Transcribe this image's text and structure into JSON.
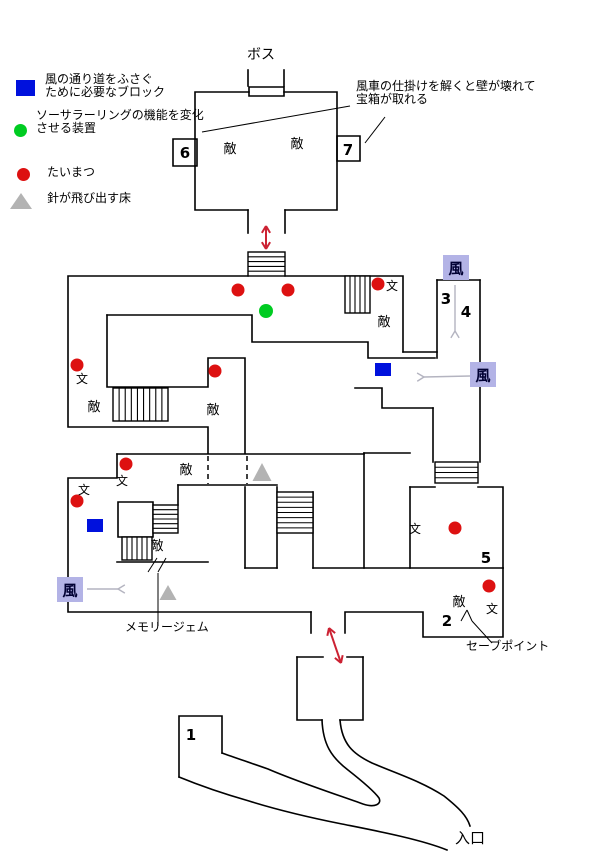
{
  "colors": {
    "wall": "#000000",
    "torch_red": "#dd1111",
    "device_green": "#00cc22",
    "block_blue": "#0011dd",
    "spike_gray": "#b3b3b3",
    "wind_box_bg": "#b3b3e6",
    "wind_text": "#000033",
    "arrow_red": "#cc2233",
    "arrow_gray": "#b4b4c0"
  },
  "legend": {
    "items": [
      {
        "marker": "blue-square",
        "lines": [
          "風の通り道をふさぐ",
          "ために必要なブロック"
        ]
      },
      {
        "marker": "green-circle",
        "lines": [
          "ソーサラーリングの機能を変化",
          "させる装置"
        ]
      },
      {
        "marker": "red-circle",
        "lines": [
          "たいまつ",
          ""
        ]
      },
      {
        "marker": "gray-triangle",
        "lines": [
          "針が飛び出す床",
          ""
        ]
      }
    ]
  },
  "labels": {
    "boss": "ボス",
    "windmill_note_line1": "風車の仕掛けを解くと壁が壊れて",
    "windmill_note_line2": "宝箱が取れる",
    "memory_gem": "メモリージェム",
    "save_point": "セーブポイント",
    "entrance": "入口"
  },
  "map": {
    "enemy_label": "敵",
    "monument_label": "文",
    "wind_label": "風",
    "walls": [
      "M249,87 h35 v9 h-35 Z",
      "M248,86 V70",
      "M284,86 V70",
      "M249,92 H195 V210 H248",
      "M284,92 H337 V210 H285",
      "M248,210 V233",
      "M285,210 V233",
      "M173,139 h24 v27 h-24 Z",
      "M337,136 h23 v25 h-23 Z",
      "M248,276 H68 V427 H208 V453",
      "M285,276 H403 V352",
      "M403,352 H437",
      "M107,315 H252 V342 H368 V358 H435",
      "M107,315 V387 H208 V358 H245 V453",
      "M437,280 V358",
      "M480,280 V462",
      "M437,280 H480",
      "M355,388 H382 V408 H433",
      "M433,408 V462",
      "M410,487 V568",
      "M410,487 H435",
      "M478,487 H503 V568",
      "M364,453 H410",
      "M364,453 V568",
      "M117,454 H364",
      "M117,454 V478 H68 V612 H311",
      "M311,612 V633",
      "M345,633 V612 H423 V637 H503 V568",
      "M178,485 H277",
      "M178,485 V505",
      "M118,502 h35 v35 h-35 Z",
      "M117,562 H208",
      "M245,487 V568",
      "M277,487 V568",
      "M245,568 H277",
      "M313,492 V568",
      "M313,568 H503",
      "M297,657 H323",
      "M347,657 H363",
      "M297,657 V720 H322",
      "M363,657 V720 H340",
      "M222,753 V716 H179 V777",
      "M322,720 C323,744 331,757 348,770 C362,781 374,791 379,798 C382,804 375,808 363,804 C338,795 298,782 268,769 C248,762 233,757 222,753",
      "M340,720 C342,744 353,754 372,763 C395,773 421,781 444,796 C459,808 467,816 470,826",
      "M179,777 C196,784 221,793 249,801 C281,811 312,818 342,824 C372,830 420,839 447,850"
    ],
    "stairs": [
      {
        "x": 248,
        "y": 252,
        "w": 37,
        "h": 24,
        "dir": "h",
        "steps": 4
      },
      {
        "x": 345,
        "y": 276,
        "w": 25,
        "h": 37,
        "dir": "v",
        "steps": 4
      },
      {
        "x": 113,
        "y": 388,
        "w": 55,
        "h": 33,
        "dir": "v",
        "steps": 8
      },
      {
        "x": 153,
        "y": 505,
        "w": 25,
        "h": 28,
        "dir": "h",
        "steps": 5
      },
      {
        "x": 122,
        "y": 537,
        "w": 30,
        "h": 23,
        "dir": "v",
        "steps": 5
      },
      {
        "x": 277,
        "y": 492,
        "w": 36,
        "h": 41,
        "dir": "h",
        "steps": 7
      },
      {
        "x": 435,
        "y": 462,
        "w": 43,
        "h": 21,
        "dir": "h",
        "steps": 3
      }
    ],
    "dashed_openings": [
      {
        "x": 208,
        "y1": 456,
        "y2": 484
      },
      {
        "x": 247,
        "y1": 456,
        "y2": 484
      }
    ],
    "pointer_lines": [
      [
        202,
        132,
        350,
        106
      ],
      [
        365,
        143,
        385,
        117
      ],
      [
        158,
        573,
        158,
        626
      ],
      [
        148,
        572,
        157,
        558
      ],
      [
        158,
        572,
        166,
        558
      ],
      [
        492,
        643,
        472,
        621
      ],
      [
        461,
        621,
        467,
        610
      ],
      [
        467,
        610,
        472,
        621
      ]
    ],
    "numbers": [
      {
        "text": "1",
        "x": 191,
        "y": 740
      },
      {
        "text": "2",
        "x": 447,
        "y": 626
      },
      {
        "text": "3",
        "x": 446,
        "y": 304
      },
      {
        "text": "4",
        "x": 466,
        "y": 317
      },
      {
        "text": "5",
        "x": 486,
        "y": 563
      },
      {
        "text": "6",
        "x": 185,
        "y": 158
      },
      {
        "text": "7",
        "x": 348,
        "y": 155
      }
    ],
    "enemy_positions": [
      [
        230,
        153
      ],
      [
        297,
        148
      ],
      [
        384,
        326
      ],
      [
        94,
        411
      ],
      [
        213,
        414
      ],
      [
        186,
        474
      ],
      [
        157,
        550
      ],
      [
        459,
        606
      ]
    ],
    "monument_positions": [
      [
        392,
        290
      ],
      [
        82,
        383
      ],
      [
        122,
        485
      ],
      [
        84,
        494
      ],
      [
        415,
        533
      ],
      [
        492,
        613
      ]
    ],
    "wind_boxes": [
      [
        443,
        255
      ],
      [
        470,
        362
      ],
      [
        57,
        577
      ]
    ],
    "torch_positions": [
      [
        238,
        290
      ],
      [
        288,
        290
      ],
      [
        378,
        284
      ],
      [
        77,
        365
      ],
      [
        215,
        371
      ],
      [
        126,
        464
      ],
      [
        77,
        501
      ],
      [
        455,
        528
      ],
      [
        489,
        586
      ]
    ],
    "device_positions": [
      [
        266,
        311
      ]
    ],
    "block_positions": [
      [
        375,
        363
      ],
      [
        87,
        519
      ]
    ],
    "spike_positions": [
      [
        262,
        481,
        19,
        18
      ],
      [
        168,
        600,
        17,
        15
      ]
    ],
    "red_arrows": [
      {
        "x1": 266,
        "y1": 249,
        "x2": 266,
        "y2": 226
      },
      {
        "x1": 329,
        "y1": 628,
        "x2": 341,
        "y2": 663
      }
    ],
    "gray_arrows": [
      {
        "x1": 455,
        "y1": 285,
        "x2": 455,
        "y2": 331
      },
      {
        "x1": 470,
        "y1": 376,
        "x2": 424,
        "y2": 377
      },
      {
        "x1": 87,
        "y1": 589,
        "x2": 118,
        "y2": 589
      }
    ]
  }
}
